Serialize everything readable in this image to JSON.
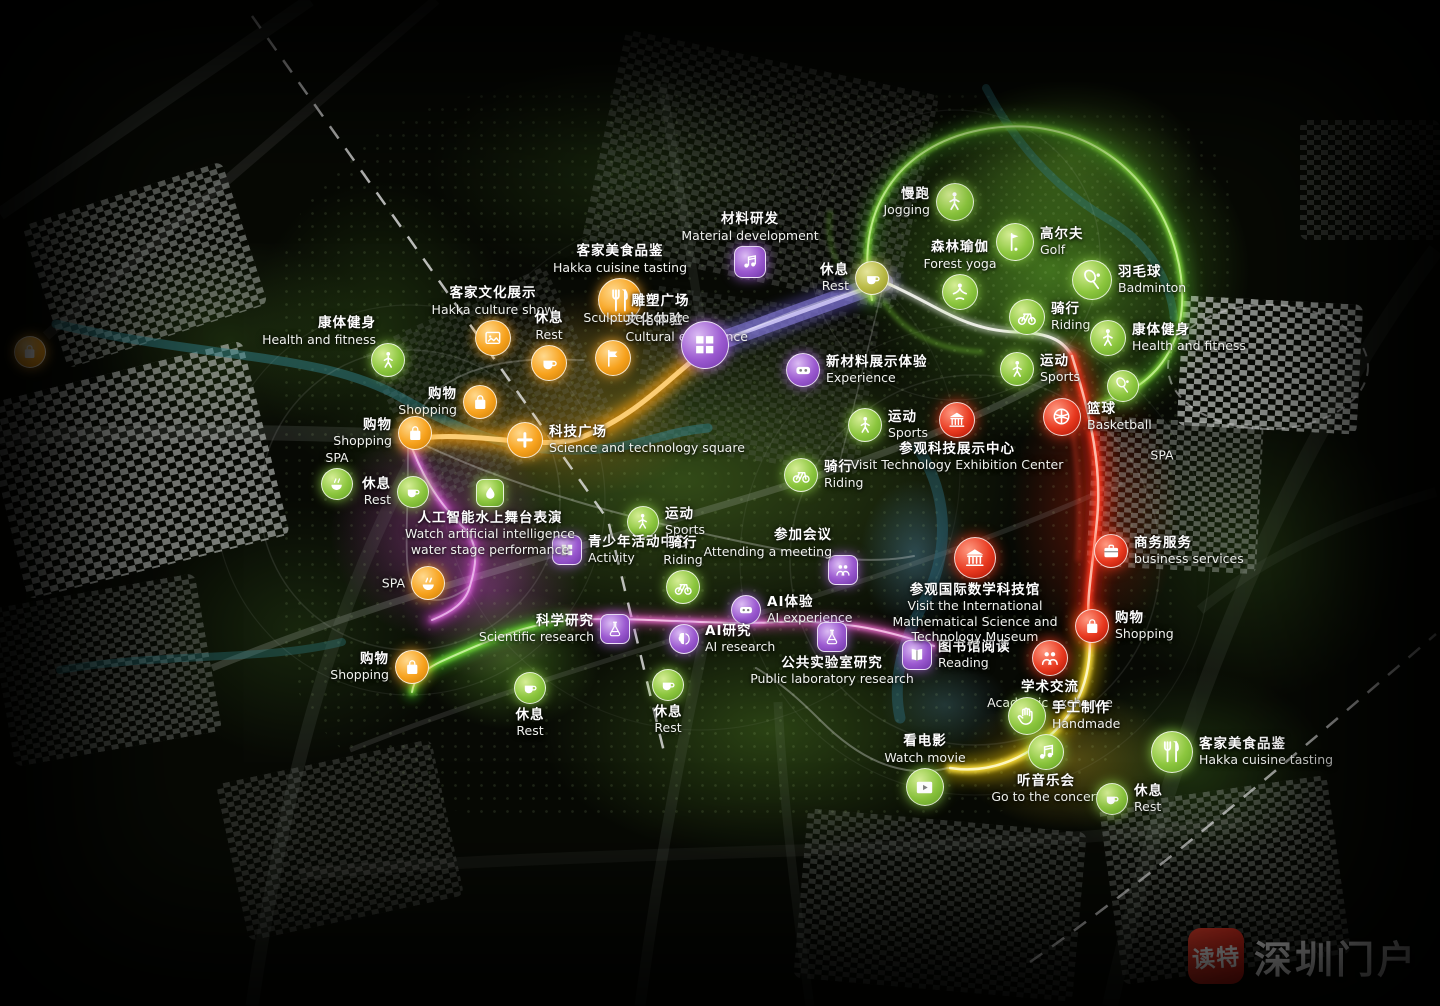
{
  "watermark": {
    "app_name": "读特",
    "site_name": "深圳门户"
  },
  "palette": {
    "poi_green": "#8cc63e",
    "poi_orange": "#f7a21d",
    "poi_purple": "#9b59d0",
    "poi_red": "#e8391f",
    "poi_olive": "#b8b944",
    "route_orange": "#ff9a00",
    "route_purple": "#9287ec",
    "route_green": "#8ae63e",
    "route_red": "#ff3b22",
    "route_yellow": "#ffe13a",
    "route_pink": "#ff7ade",
    "route_magenta": "#ea78ea",
    "watermark_red": "#d5281e"
  },
  "pois": [
    {
      "id": "jogging",
      "zh": "慢跑",
      "en": "Jogging",
      "color": "green",
      "icon": "person",
      "x": 955,
      "y": 202,
      "label": "left",
      "size": 36
    },
    {
      "id": "golf",
      "zh": "高尔夫",
      "en": "Golf",
      "color": "green",
      "icon": "golf",
      "x": 1015,
      "y": 242,
      "label": "right",
      "size": 36
    },
    {
      "id": "forest-yoga",
      "zh": "森林瑜伽",
      "en": "Forest yoga",
      "color": "green",
      "icon": "yoga",
      "x": 960,
      "y": 292,
      "label": "above",
      "size": 34
    },
    {
      "id": "badminton",
      "zh": "羽毛球",
      "en": "Badminton",
      "color": "green",
      "icon": "racket",
      "x": 1092,
      "y": 280,
      "label": "right",
      "size": 38
    },
    {
      "id": "riding-ne",
      "zh": "骑行",
      "en": "Riding",
      "color": "green",
      "icon": "bike",
      "x": 1027,
      "y": 317,
      "label": "right",
      "size": 34
    },
    {
      "id": "health-right",
      "zh": "康体健身",
      "en": "Health and fitness",
      "color": "green",
      "icon": "person",
      "x": 1108,
      "y": 338,
      "label": "right",
      "size": 34
    },
    {
      "id": "sports-right",
      "zh": "运动",
      "en": "Sports",
      "color": "green",
      "icon": "person",
      "x": 1017,
      "y": 369,
      "label": "right",
      "size": 32
    },
    {
      "id": "racket-extra",
      "zh": "",
      "en": "",
      "color": "green",
      "icon": "racket",
      "x": 1123,
      "y": 386,
      "label": "right",
      "size": 30
    },
    {
      "id": "basketball",
      "zh": "篮球",
      "en": "Basketball",
      "color": "red",
      "icon": "ball",
      "x": 1062,
      "y": 417,
      "label": "right",
      "size": 36
    },
    {
      "id": "spa-right",
      "zh": "",
      "en": "SPA",
      "color": "green",
      "icon": "",
      "x": 1162,
      "y": 455,
      "label": "center",
      "size": 30
    },
    {
      "id": "health-left",
      "zh": "康体健身",
      "en": "Health and fitness",
      "color": "green",
      "icon": "person",
      "x": 388,
      "y": 360,
      "label": "upleft",
      "size": 32
    },
    {
      "id": "shopping-left-1",
      "zh": "购物",
      "en": "Shopping",
      "color": "orange",
      "icon": "bag",
      "x": 480,
      "y": 402,
      "label": "left",
      "size": 32
    },
    {
      "id": "shopping-left-2",
      "zh": "购物",
      "en": "Shopping",
      "color": "orange",
      "icon": "bag",
      "x": 415,
      "y": 433,
      "label": "left",
      "size": 32
    },
    {
      "id": "spa-left",
      "zh": "",
      "en": "SPA",
      "color": "green",
      "icon": "spa",
      "x": 337,
      "y": 484,
      "label": "above",
      "size": 30
    },
    {
      "id": "rest-left",
      "zh": "休息",
      "en": "Rest",
      "color": "green",
      "icon": "cup",
      "x": 413,
      "y": 492,
      "label": "left",
      "size": 30
    },
    {
      "id": "hakka-culture-show",
      "zh": "客家文化展示",
      "en": "Hakka culture show",
      "color": "orange",
      "icon": "photo",
      "x": 493,
      "y": 338,
      "label": "above",
      "size": 34
    },
    {
      "id": "rest-top",
      "zh": "休息",
      "en": "Rest",
      "color": "orange",
      "icon": "cup",
      "x": 549,
      "y": 363,
      "label": "above",
      "size": 34
    },
    {
      "id": "hakka-cuisine-top",
      "zh": "客家美食品鉴",
      "en": "Hakka cuisine tasting",
      "color": "orange",
      "icon": "fork",
      "x": 620,
      "y": 300,
      "label": "above",
      "size": 42
    },
    {
      "id": "cultural-experience",
      "zh": "文化体验",
      "en": "Cultural experience",
      "color": "orange",
      "icon": "flag",
      "x": 613,
      "y": 358,
      "label": "upright",
      "size": 34
    },
    {
      "id": "sculpture-square",
      "zh": "雕塑广场",
      "en": "Sculpture square",
      "color": "purple",
      "icon": "grid",
      "x": 705,
      "y": 345,
      "label": "upleft",
      "size": 46
    },
    {
      "id": "material-development",
      "zh": "材料研发",
      "en": "Material development",
      "color": "purple",
      "icon": "note",
      "x": 750,
      "y": 262,
      "label": "above",
      "size": 30,
      "sq": true
    },
    {
      "id": "rest-topcenter",
      "zh": "休息",
      "en": "Rest",
      "color": "olive",
      "icon": "cup",
      "x": 872,
      "y": 278,
      "label": "left",
      "size": 32
    },
    {
      "id": "experience-newmaterial",
      "zh": "新材料展示体验",
      "en": "Experience",
      "color": "purple",
      "icon": "vr",
      "x": 803,
      "y": 370,
      "label": "right",
      "size": 32
    },
    {
      "id": "sports-center",
      "zh": "运动",
      "en": "Sports",
      "color": "green",
      "icon": "person",
      "x": 865,
      "y": 425,
      "label": "right",
      "size": 32
    },
    {
      "id": "riding-center",
      "zh": "骑行",
      "en": "Riding",
      "color": "green",
      "icon": "bike",
      "x": 801,
      "y": 475,
      "label": "right",
      "size": 32
    },
    {
      "id": "visit-tech-center",
      "zh": "参观科技展示中心",
      "en": "Visit Technology Exhibition Center",
      "color": "red",
      "icon": "bank",
      "x": 957,
      "y": 420,
      "label": "below",
      "size": 34,
      "lw": 240
    },
    {
      "id": "sports-lower",
      "zh": "运动",
      "en": "Sports",
      "color": "green",
      "icon": "person",
      "x": 643,
      "y": 522,
      "label": "right",
      "size": 30
    },
    {
      "id": "activity-center",
      "zh": "青少年活动中心",
      "en": "Activity",
      "color": "purple",
      "icon": "grid",
      "x": 567,
      "y": 550,
      "label": "right",
      "size": 28,
      "sq": true
    },
    {
      "id": "riding-lower",
      "zh": "骑行",
      "en": "Riding",
      "color": "green",
      "icon": "bike",
      "x": 683,
      "y": 587,
      "label": "above",
      "size": 32
    },
    {
      "id": "attending-meeting",
      "zh": "参加会议",
      "en": "Attending a meeting",
      "color": "purple",
      "icon": "people",
      "x": 843,
      "y": 570,
      "label": "upleft",
      "size": 28,
      "sq": true
    },
    {
      "id": "ai-water-stage",
      "zh": "人工智能水上舞台表演",
      "en": "Watch artificial intelligence water stage performance",
      "color": "green",
      "icon": "drop",
      "x": 490,
      "y": 493,
      "label": "below",
      "size": 26,
      "sq": true,
      "lw": 195
    },
    {
      "id": "spa-bottomleft",
      "zh": "",
      "en": "SPA",
      "color": "orange",
      "icon": "spa",
      "x": 428,
      "y": 583,
      "label": "left",
      "size": 32
    },
    {
      "id": "shopping-bottomleft",
      "zh": "购物",
      "en": "Shopping",
      "color": "orange",
      "icon": "bag",
      "x": 412,
      "y": 667,
      "label": "left",
      "size": 32
    },
    {
      "id": "scientific-research",
      "zh": "科学研究",
      "en": "Scientific research",
      "color": "purple",
      "icon": "flask",
      "x": 615,
      "y": 629,
      "label": "left",
      "size": 28,
      "sq": true
    },
    {
      "id": "ai-experience",
      "zh": "AI体验",
      "en": "AI experience",
      "color": "purple",
      "icon": "vr",
      "x": 746,
      "y": 610,
      "label": "right",
      "size": 28
    },
    {
      "id": "ai-research",
      "zh": "AI研究",
      "en": "AI research",
      "color": "purple",
      "icon": "brain",
      "x": 684,
      "y": 639,
      "label": "right",
      "size": 28
    },
    {
      "id": "public-lab-research",
      "zh": "公共实验室研究",
      "en": "Public laboratory research",
      "color": "purple",
      "icon": "flask",
      "x": 832,
      "y": 637,
      "label": "below",
      "size": 28,
      "sq": true,
      "lw": 185
    },
    {
      "id": "reading",
      "zh": "图书馆阅读",
      "en": "Reading",
      "color": "purple",
      "icon": "book",
      "x": 917,
      "y": 655,
      "label": "right",
      "size": 28,
      "sq": true
    },
    {
      "id": "math-museum",
      "zh": "参观国际数学科技馆",
      "en": "Visit the International Mathematical Science and Technology Museum",
      "color": "red",
      "icon": "bank",
      "x": 975,
      "y": 558,
      "label": "below",
      "size": 40,
      "lw": 190
    },
    {
      "id": "business-services",
      "zh": "商务服务",
      "en": "business services",
      "color": "red",
      "icon": "case",
      "x": 1111,
      "y": 551,
      "label": "right",
      "size": 32
    },
    {
      "id": "shopping-right",
      "zh": "购物",
      "en": "Shopping",
      "color": "red",
      "icon": "bag",
      "x": 1092,
      "y": 626,
      "label": "right",
      "size": 32
    },
    {
      "id": "academic-exchange",
      "zh": "学术交流",
      "en": "Academic exchange",
      "color": "red",
      "icon": "people",
      "x": 1050,
      "y": 658,
      "label": "below",
      "size": 34
    },
    {
      "id": "handmade",
      "zh": "手工制作",
      "en": "Handmade",
      "color": "green",
      "icon": "hand",
      "x": 1027,
      "y": 716,
      "label": "right",
      "size": 36
    },
    {
      "id": "watch-movie",
      "zh": "看电影",
      "en": "Watch movie",
      "color": "green",
      "icon": "film",
      "x": 925,
      "y": 787,
      "label": "above",
      "size": 36
    },
    {
      "id": "concert",
      "zh": "听音乐会",
      "en": "Go to the concert",
      "color": "green",
      "icon": "note",
      "x": 1046,
      "y": 752,
      "label": "below",
      "size": 34
    },
    {
      "id": "rest-bottomright",
      "zh": "休息",
      "en": "Rest",
      "color": "green",
      "icon": "cup",
      "x": 1112,
      "y": 799,
      "label": "right",
      "size": 30
    },
    {
      "id": "hakka-cuisine-bottom",
      "zh": "客家美食品鉴",
      "en": "Hakka cuisine tasting",
      "color": "green",
      "icon": "fork",
      "x": 1172,
      "y": 752,
      "label": "right",
      "size": 40
    },
    {
      "id": "rest-bottom-1",
      "zh": "休息",
      "en": "Rest",
      "color": "green",
      "icon": "cup",
      "x": 530,
      "y": 688,
      "label": "below",
      "size": 30
    },
    {
      "id": "rest-bottom-2",
      "zh": "休息",
      "en": "Rest",
      "color": "green",
      "icon": "cup",
      "x": 668,
      "y": 685,
      "label": "below",
      "size": 30
    },
    {
      "id": "science-square",
      "zh": "科技广场",
      "en": "Science and technology square",
      "color": "orange",
      "icon": "plus",
      "x": 525,
      "y": 440,
      "label": "right",
      "size": 34,
      "lw": 220
    },
    {
      "id": "shopping-edge",
      "zh": "",
      "en": "",
      "color": "orange",
      "icon": "bag",
      "x": 30,
      "y": 352,
      "label": "right",
      "size": 30
    }
  ]
}
